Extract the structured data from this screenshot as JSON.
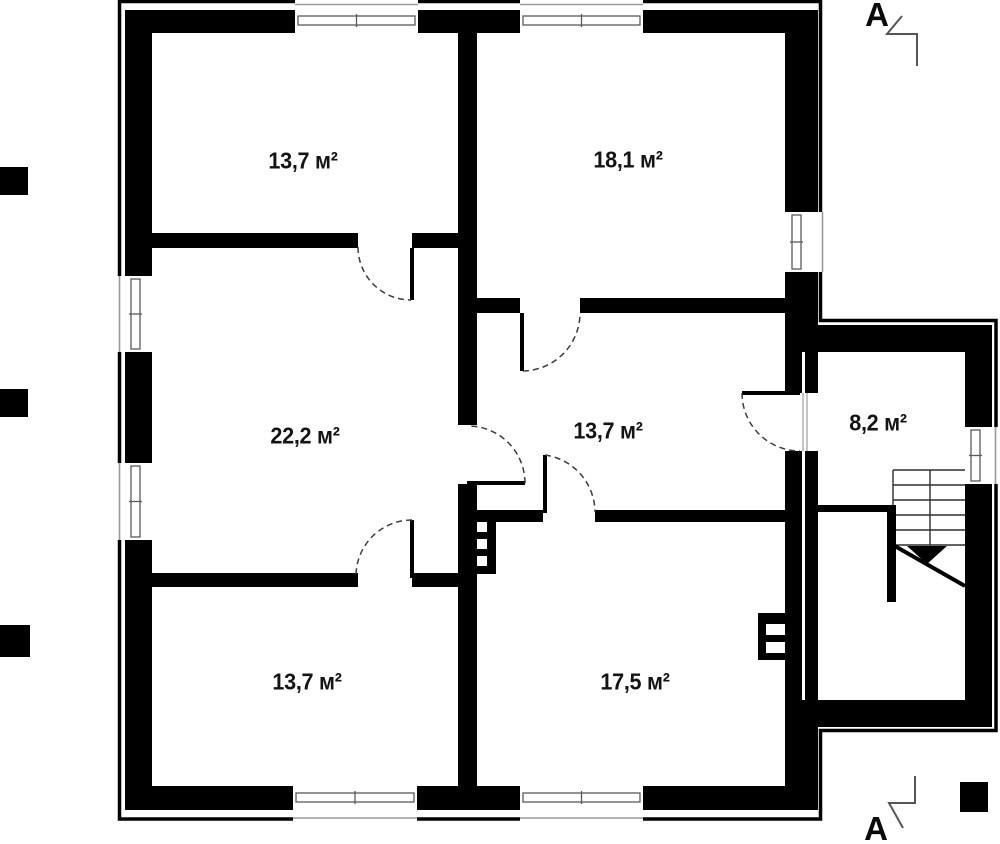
{
  "plan": {
    "type": "architectural-floor-plan",
    "units": "м²",
    "rooms": [
      {
        "id": "room-top-left",
        "area_label": "13,7 м²"
      },
      {
        "id": "room-top-right",
        "area_label": "18,1 м²"
      },
      {
        "id": "room-living",
        "area_label": "22,2 м²"
      },
      {
        "id": "room-hallway",
        "area_label": "13,7 м²"
      },
      {
        "id": "room-stair-hall",
        "area_label": "8,2 м²"
      },
      {
        "id": "room-bottom-left",
        "area_label": "13,7 м²"
      },
      {
        "id": "room-bottom-right",
        "area_label": "17,5 м²"
      }
    ],
    "section_markers": {
      "top": "A",
      "bottom": "A"
    },
    "counts": {
      "windows": 8,
      "doors": 6,
      "stair_flights": 1
    },
    "colors": {
      "wall": "#000000",
      "background": "#ffffff",
      "window_frame": "#5a5a5a",
      "sill_line": "#9a9a9a",
      "door_arc": "#3d3d3d",
      "section_line": "#555555"
    }
  }
}
